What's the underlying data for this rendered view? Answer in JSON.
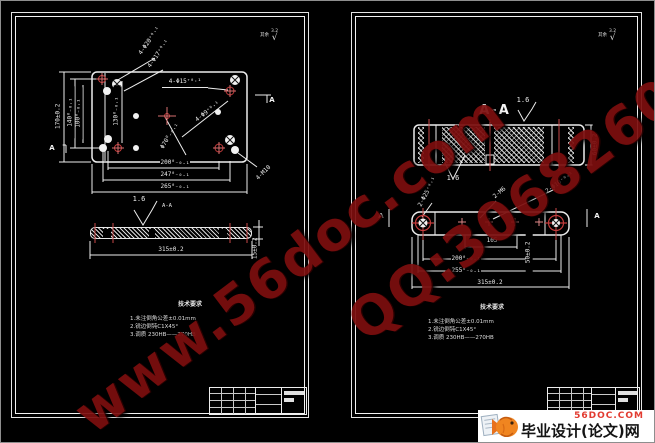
{
  "watermark": {
    "site": "www.56doc.com",
    "qq": "QQ:30682606"
  },
  "logo": {
    "domain": "56DOC.COM",
    "title": "毕业设计(论文)网"
  },
  "left": {
    "surplus": "其余",
    "roughness": "3.2",
    "check": "√",
    "callouts": {
      "c20": "4-Φ20⁺⁰·¹",
      "c17": "4-Φ17⁺⁰·¹",
      "c15": "4-Φ15⁺⁰·¹",
      "c9": "4-Φ9⁺⁰·¹",
      "c70": "Φ70⁰₋₀.₁",
      "m10": "4-M10"
    },
    "dims": {
      "d170": "170±0.2",
      "d140": "140⁰₋₀.₁",
      "d100": "100⁰₋₀.₁",
      "d130": "130⁰₋₀.₁",
      "d200": "200⁰₋₀.₁",
      "d247": "247⁰₋₀.₁",
      "d265": "265⁰₋₀.₁",
      "d315": "315±0.2",
      "d15": "15±0.2"
    },
    "labels": {
      "section": "A-A",
      "finish": "1.6",
      "cut_a": "A"
    },
    "notes": {
      "title": "技术要求",
      "n1": "1.未注倒角公差±0.01mm",
      "n2": "2.锐边倒钝C1X45°",
      "n3": "3.调质  230HB——270HB"
    }
  },
  "right": {
    "surplus": "其余",
    "roughness": "3.2",
    "check": "√",
    "callouts": {
      "c25": "2-Φ25⁺⁰·¹",
      "m6": "2-M6",
      "c10": "2-Φ10⁺⁰·¹"
    },
    "dims": {
      "d105": "105",
      "d50": "50±0.2",
      "d60": "60±0.2",
      "d200": "200⁰₋₀.₁",
      "d255": "255⁰₋₀.₁",
      "d315": "315±0.2"
    },
    "labels": {
      "section": "A-A",
      "finish": "1.6",
      "cut_a": "A"
    },
    "notes": {
      "title": "技术要求",
      "n1": "1.未注倒角公差±0.01mm",
      "n2": "2.锐边倒钝C1X45°",
      "n3": "3.调质  230HB——270HB"
    }
  }
}
